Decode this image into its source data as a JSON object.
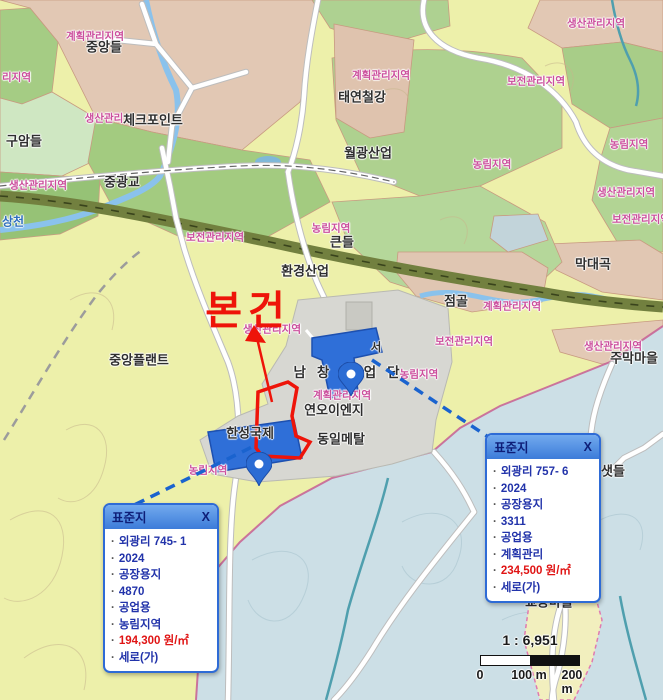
{
  "colors": {
    "subject_red": "#ee1409",
    "price_red": "#e01414",
    "popup_border_blue": "#2e6bd6",
    "popup_item_blue": "#2233aa",
    "dashed_leader_blue": "#1a63cf",
    "zone_label_pink": "#cb4e9c",
    "place_label_dark": "#2e2e2e",
    "water_label_blue": "#2f6fbe"
  },
  "map": {
    "subject_label": "본건",
    "labels": [
      {
        "text": "계획관리지역"
      },
      {
        "text": "중앙들"
      },
      {
        "text": "리지역"
      },
      {
        "text": "생산관리"
      },
      {
        "text": "체크포인트"
      },
      {
        "text": "구암들"
      },
      {
        "text": "계획관리지역"
      },
      {
        "text": "태연철강"
      },
      {
        "text": "월광산업"
      },
      {
        "text": "생산관리지역"
      },
      {
        "text": "보전관리지역"
      },
      {
        "text": "농림지역"
      },
      {
        "text": "농림지역"
      },
      {
        "text": "생산관리지역"
      },
      {
        "text": "중광교"
      },
      {
        "text": "상천"
      },
      {
        "text": "보전관리지역"
      },
      {
        "text": "농림지역"
      },
      {
        "text": "큰들"
      },
      {
        "text": "환경산업"
      },
      {
        "text": "생산관리지역"
      },
      {
        "text": "보전관리지역"
      },
      {
        "text": "막대곡"
      },
      {
        "text": "점골"
      },
      {
        "text": "계획관리지역"
      },
      {
        "text": "생산관리지역"
      },
      {
        "text": "중앙플랜트"
      },
      {
        "text": "남창공업단"
      },
      {
        "text": "서"
      },
      {
        "text": "계획관리지역"
      },
      {
        "text": "연오이엔지"
      },
      {
        "text": "동일메탈"
      },
      {
        "text": "농림지역"
      },
      {
        "text": "보전관리지역"
      },
      {
        "text": "생산관리지역"
      },
      {
        "text": "주막마을"
      },
      {
        "text": "한성국제"
      },
      {
        "text": "농림지역"
      },
      {
        "text": "샛들"
      },
      {
        "text": "집단취락지구"
      },
      {
        "text": "교동마을"
      }
    ]
  },
  "popups": {
    "left": {
      "title": "표준지",
      "close": "X",
      "items": [
        "외광리 745- 1",
        "2024",
        "공장용지",
        "4870",
        "공업용",
        "농림지역",
        "194,300 원/㎡",
        "세로(가)"
      ]
    },
    "right": {
      "title": "표준지",
      "close": "X",
      "items": [
        "외광리 757- 6",
        "2024",
        "공장용지",
        "3311",
        "공업용",
        "계획관리",
        "234,500 원/㎡",
        "세로(가)"
      ]
    }
  },
  "scale": {
    "ratio": "1 : 6,951",
    "tick0": "0",
    "tick100": "100 m",
    "tick200": "200 m"
  }
}
